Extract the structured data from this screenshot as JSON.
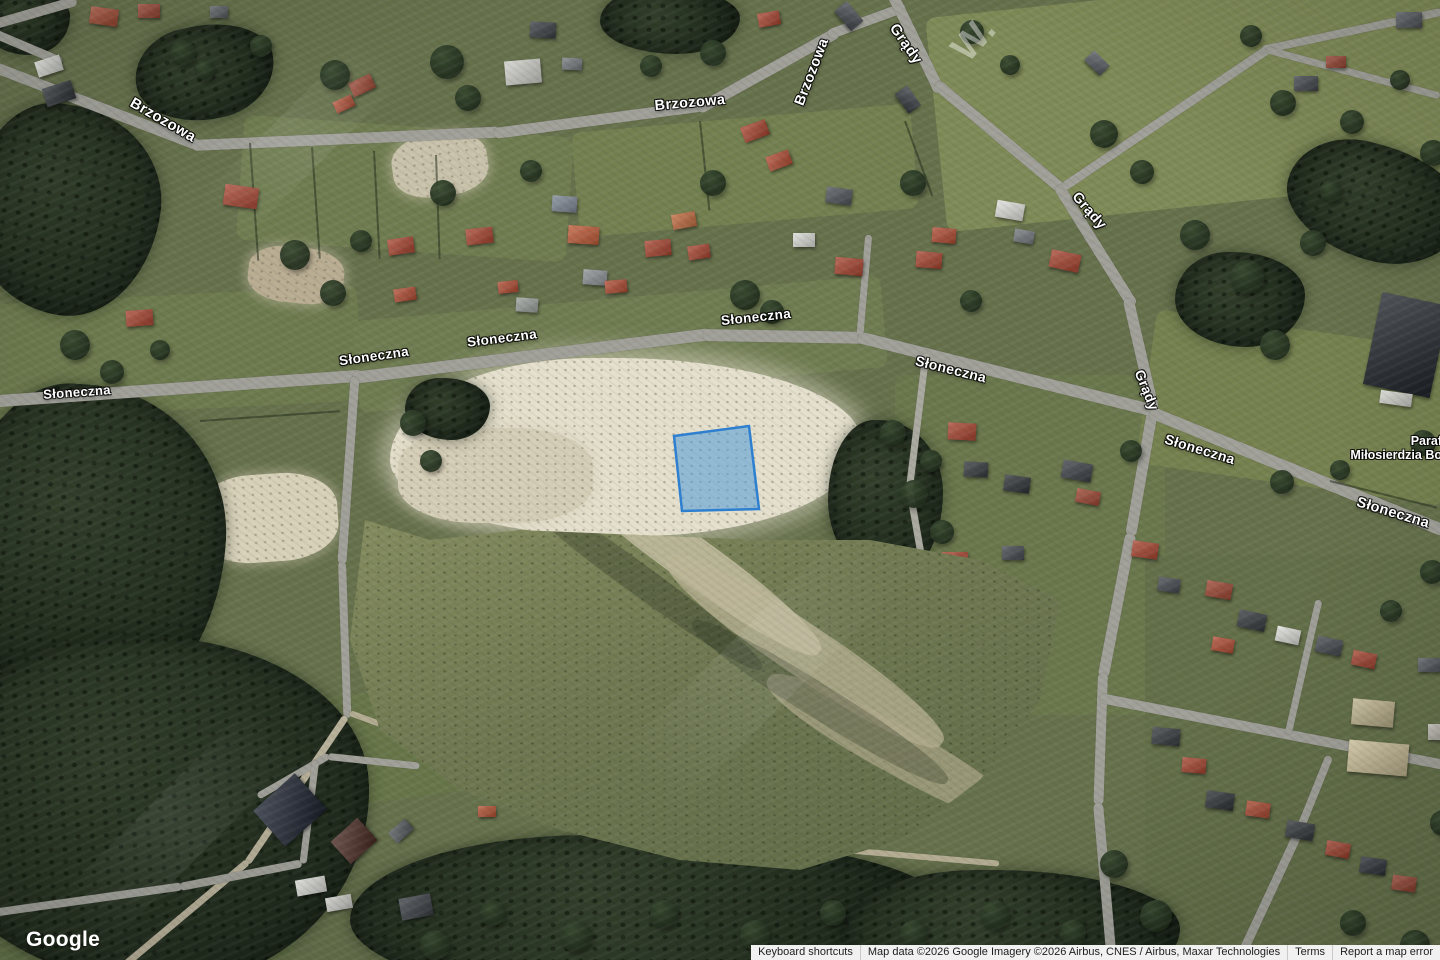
{
  "labels": {
    "brzozowa": "Brzozowa",
    "grady": "Grądy",
    "sloneczna": "Słoneczna"
  },
  "place": {
    "line1": "Paraf",
    "line2": "Miłosierdzia Bo"
  },
  "watermark": "W.",
  "parcel": {
    "fill": "#4f9bd8",
    "fill_opacity": "0.55",
    "stroke": "#2e7fd0",
    "stroke_width": "2.5"
  },
  "google_logo": "Google",
  "attribution": {
    "keyboard_shortcuts": "Keyboard shortcuts",
    "map_data": "Map data ©2026 Google Imagery ©2026 Airbus, CNES / Airbus, Maxar Technologies",
    "terms": "Terms",
    "report": "Report a map error"
  }
}
